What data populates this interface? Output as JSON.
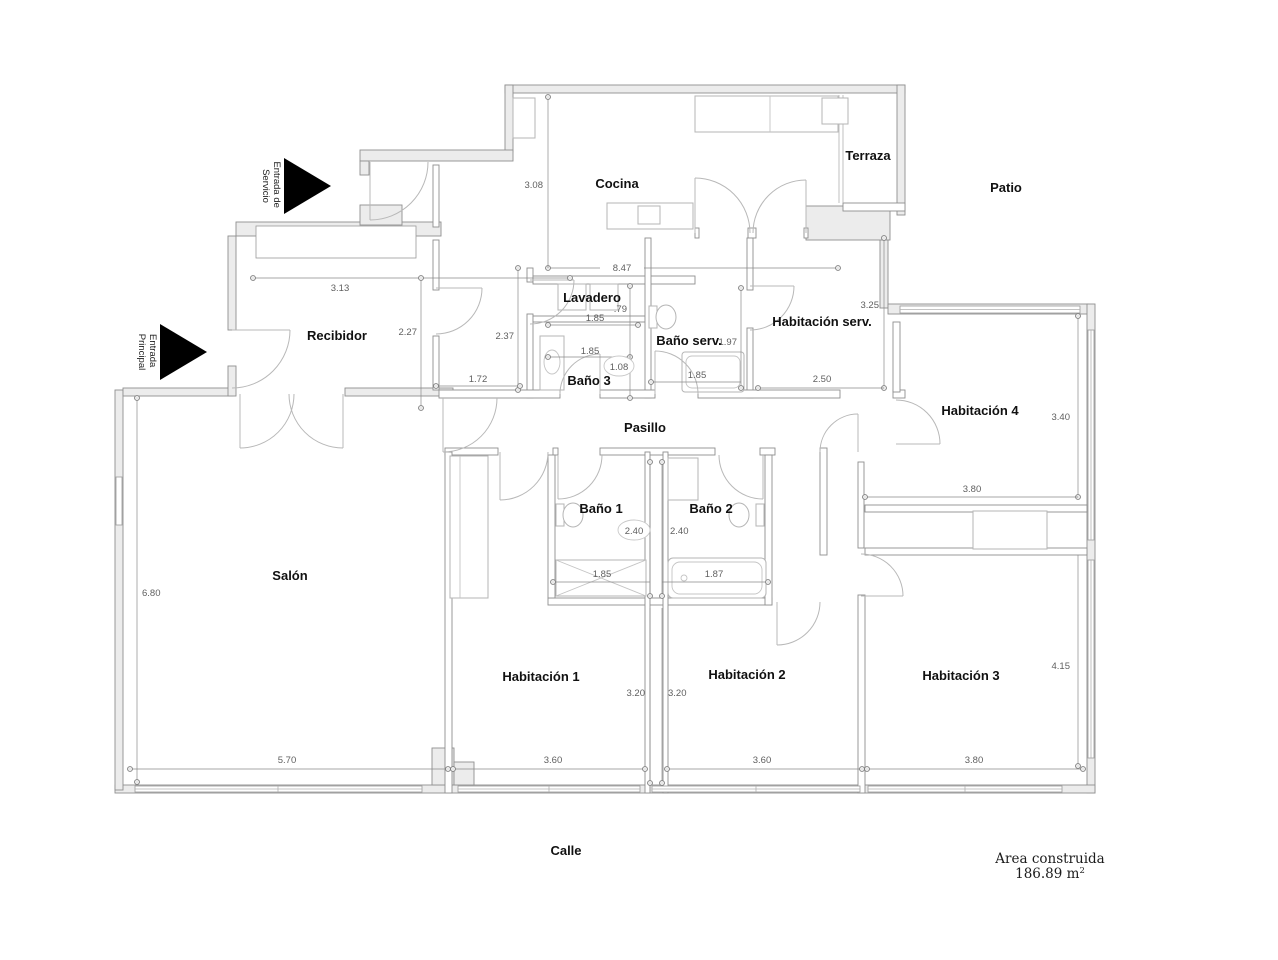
{
  "plan": {
    "rooms": [
      {
        "id": "cocina",
        "label": "Cocina"
      },
      {
        "id": "terraza",
        "label": "Terraza"
      },
      {
        "id": "lavadero",
        "label": "Lavadero"
      },
      {
        "id": "bano-serv",
        "label": "Baño serv."
      },
      {
        "id": "habitacion-serv",
        "label": "Habitación serv."
      },
      {
        "id": "recibidor",
        "label": "Recibidor"
      },
      {
        "id": "bano-3",
        "label": "Baño 3"
      },
      {
        "id": "pasillo",
        "label": "Pasillo"
      },
      {
        "id": "habitacion-4",
        "label": "Habitación 4"
      },
      {
        "id": "bano-1",
        "label": "Baño 1"
      },
      {
        "id": "bano-2",
        "label": "Baño 2"
      },
      {
        "id": "salon",
        "label": "Salón"
      },
      {
        "id": "habitacion-1",
        "label": "Habitación 1"
      },
      {
        "id": "habitacion-2",
        "label": "Habitación 2"
      },
      {
        "id": "habitacion-3",
        "label": "Habitación 3"
      }
    ],
    "exterior": [
      {
        "id": "patio",
        "label": "Patio"
      },
      {
        "id": "calle",
        "label": "Calle"
      }
    ],
    "entrances": [
      {
        "id": "entrada-servicio",
        "line1": "Entrada de",
        "line2": "Servicio"
      },
      {
        "id": "entrada-principal",
        "line1": "Entrada",
        "line2": "Principal"
      }
    ],
    "dims": [
      "8.47",
      "3.08",
      "3.13",
      "2.27",
      "2.37",
      "1.72",
      "1.85",
      ".79",
      "1.85",
      "1.08",
      "1.97",
      "1.85",
      "3.25",
      "2.50",
      "3.40",
      "3.80",
      "2.40",
      "2.40",
      "1.85",
      "1.87",
      "6.80",
      "5.70",
      "3.60",
      "3.20",
      "3.20",
      "3.60",
      "3.80",
      "4.15"
    ],
    "footer": {
      "line1": "Area construida",
      "value": "186.89 m",
      "sup": "2"
    }
  }
}
